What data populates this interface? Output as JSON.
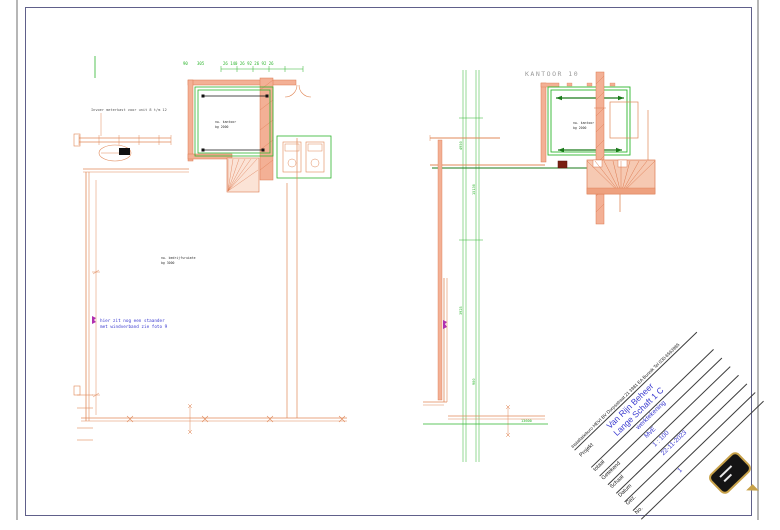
{
  "sheet": {
    "background": "#ffffff",
    "frame_color": "#60608a"
  },
  "left_plan": {
    "invoer_note": "Invoer meterkast voor unit 8 t/m 12",
    "dims_top": [
      "90",
      "305",
      "26 140 26 92 26 92 26"
    ],
    "room_label": [
      "nw. kantoor",
      "bg 2000"
    ],
    "hall_label": [
      "nw. bedrijfsruimte",
      "bg 3000"
    ],
    "note": [
      "hier zit nog een staander",
      "met windverband zie foto 9"
    ]
  },
  "right_plan": {
    "area_label": "KANTOOR 10",
    "room_label": [
      "nw. kantoor",
      "bg 2000"
    ],
    "dims_vertical": [
      "4950",
      "15130",
      "3925",
      "900"
    ],
    "dim_bottom": "13600"
  },
  "title_block": {
    "company": "Installatieburo HEVI BV   Dorpsstraat 21   3981 EA   Bunnik   Tel 030-6563985",
    "project_label": "Projekt",
    "project_value": "Van Rijn Beheer",
    "project_address": "Lange Schaft 1 C",
    "rows": [
      {
        "label": "totaal",
        "value": "werktekening"
      },
      {
        "label": "Getekend",
        "value": "MvE"
      },
      {
        "label": "Schaal",
        "value": "1 : 100"
      },
      {
        "label": "Datum",
        "value": "22-11-2023"
      },
      {
        "label": "Gez.",
        "value": ""
      },
      {
        "label": "No.",
        "value": "1"
      }
    ]
  },
  "colors": {
    "wall": "#f3b095",
    "wall_stroke": "#dd7a50",
    "dim_green": "#2db52d",
    "arrow_green": "#1a7a1a",
    "note_blue": "#3a3ad0",
    "marker_magenta": "#b030b0",
    "logo_gold": "#c8a24a"
  }
}
